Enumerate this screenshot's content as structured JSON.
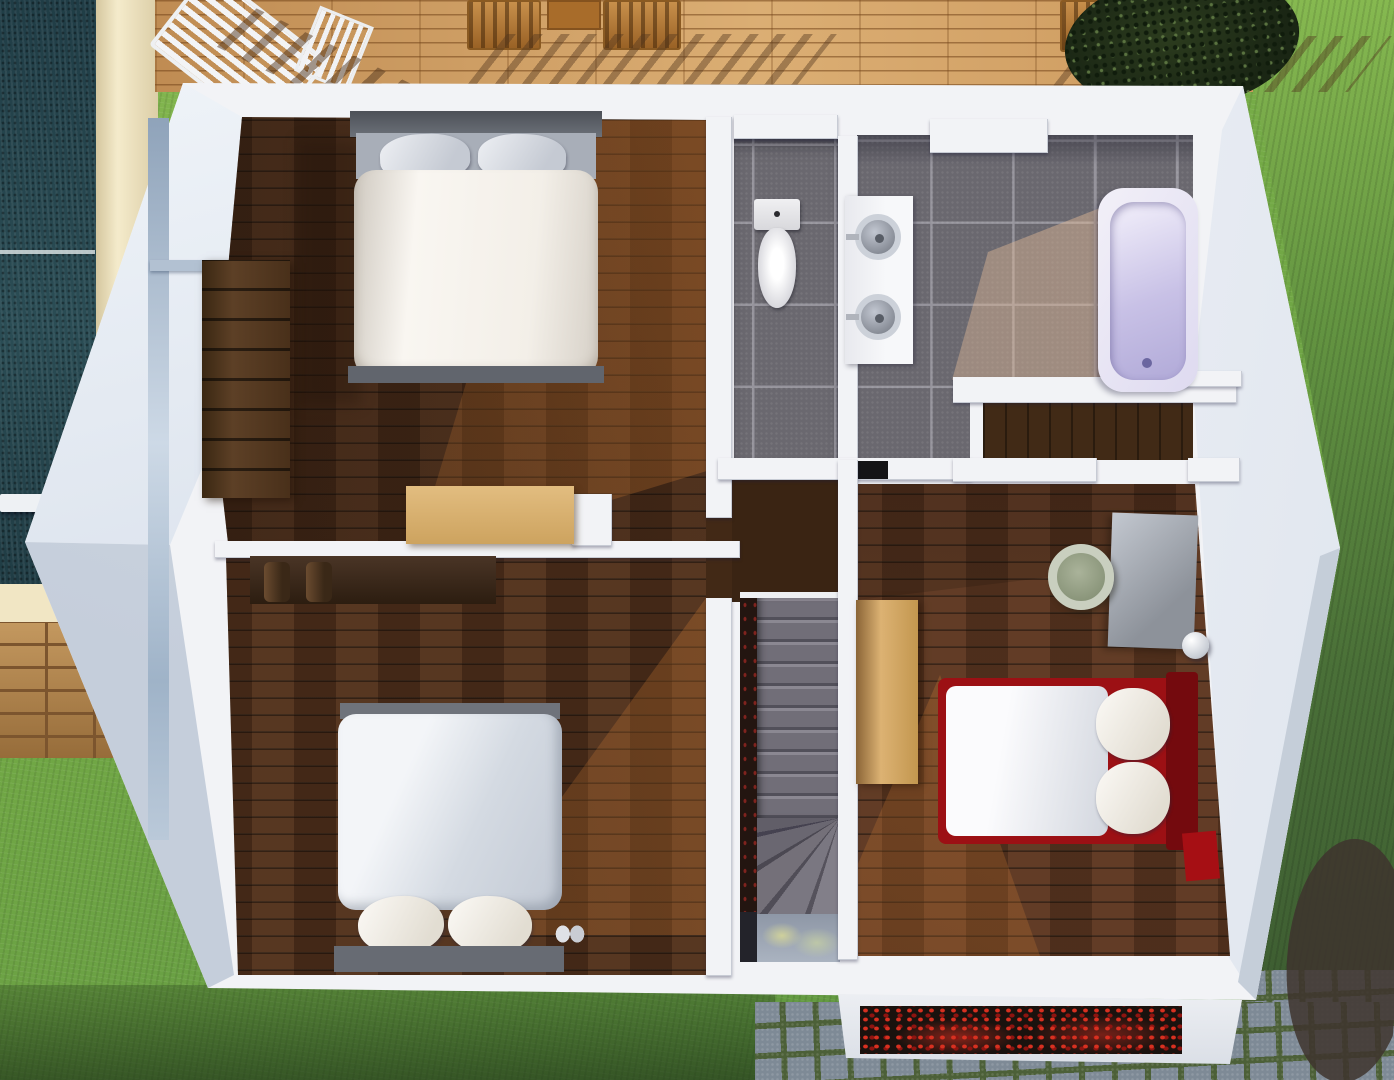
{
  "canvas": {
    "width": 1394,
    "height": 1080
  },
  "scene_type": "3d-floor-plan-top-view-upper-storey",
  "colors": {
    "grass-base": "#6fa645",
    "pool": "#28464f",
    "path": "#f1e6c4",
    "deck": "#cf9d63",
    "wall": "#f2f3f6",
    "wood": "#4e2f1b",
    "tile": "#6a686f",
    "red-bed": "#9c1014",
    "tub-lavender": "#c8c1e6",
    "stair-carpet": "#716e78",
    "pavers-stone": "#7e8a96",
    "bush-dark": "#2c3a23",
    "bush-pink": "#c587a2"
  },
  "exterior": {
    "areas": [
      "swimming-pool",
      "pool-path",
      "wood-deck",
      "lawn",
      "cobblestone-pavers",
      "dark-shrub",
      "pink-flower-shrub",
      "entrance-canopy-with-red-plants"
    ],
    "deck_furniture": [
      "white-slatted-lounger",
      "wooden-chair-set-left",
      "wooden-chair-set-right"
    ]
  },
  "rooms": [
    {
      "name": "bedroom-top-left",
      "floor": "dark-wood",
      "furniture": [
        "double-bed-white-duvet-gray-pillows",
        "walnut-wardrobe",
        "beige-chest"
      ]
    },
    {
      "name": "wc",
      "floor": "gray-tile",
      "furniture": [
        "toilet"
      ]
    },
    {
      "name": "bathroom",
      "floor": "gray-tile",
      "furniture": [
        "double-sink-counter",
        "bathtub-lavender",
        "white-ledge"
      ]
    },
    {
      "name": "hallway-landing",
      "floor": "dark-wood",
      "furniture": []
    },
    {
      "name": "staircase",
      "floor": "gray-carpet",
      "furniture": [
        "straight-treads",
        "winder-treads",
        "lower-landing"
      ]
    },
    {
      "name": "bedroom-bottom-left",
      "floor": "dark-wood",
      "furniture": [
        "double-bed-light-duvet-white-pillows",
        "dark-wood-desk"
      ]
    },
    {
      "name": "bedroom-right",
      "floor": "dark-wood",
      "furniture": [
        "red-frame-bed-white-mattress",
        "gray-desk",
        "sage-round-chair",
        "tan-dresser",
        "white-sphere-lamp"
      ]
    }
  ]
}
